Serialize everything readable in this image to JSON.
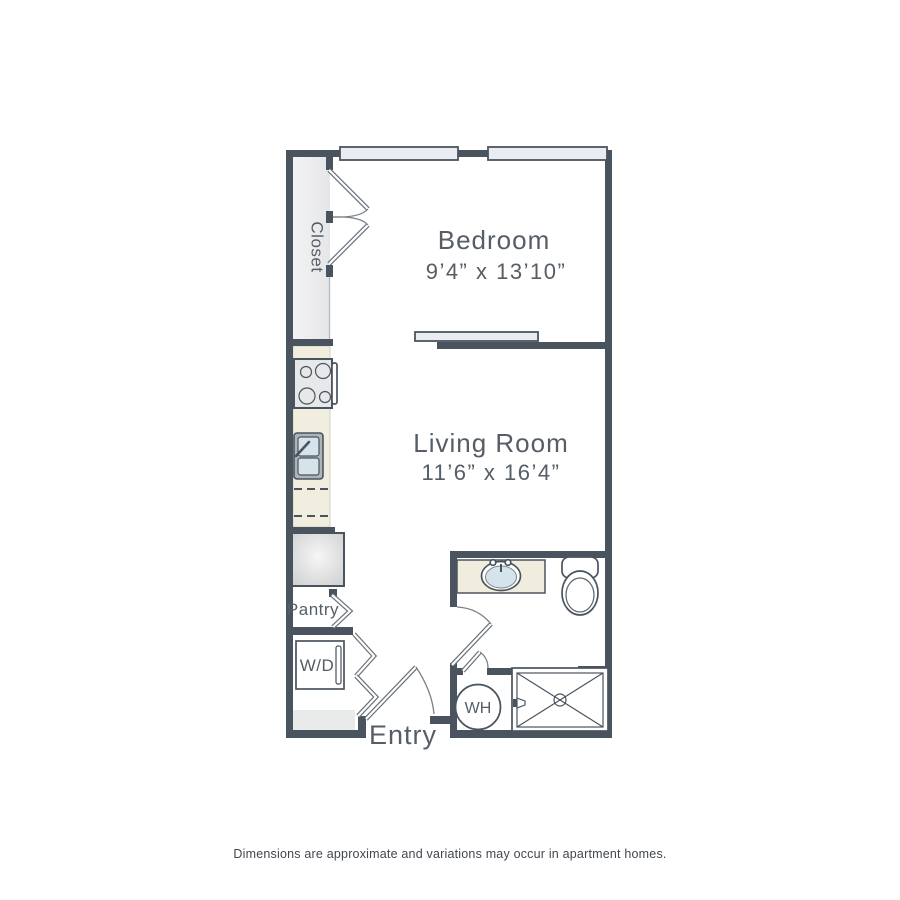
{
  "plan": {
    "rooms": {
      "closet": {
        "name": "Closet"
      },
      "bedroom": {
        "name": "Bedroom",
        "dimensions": "9’4” x 13’10”"
      },
      "living_room": {
        "name": "Living Room",
        "dimensions": "11’6” x 16’4”"
      },
      "pantry": {
        "name": "Pantry"
      },
      "washer_dryer": {
        "label": "W/D"
      },
      "entry": {
        "name": "Entry"
      },
      "water_heater": {
        "label": "WH"
      }
    },
    "fixtures": [
      "window",
      "window",
      "closet-double-doors",
      "sliding-door",
      "stove",
      "kitchen-sink",
      "dishwasher",
      "refrigerator",
      "pantry-bifold-door",
      "washer-dryer",
      "bifold-doors",
      "entry-door",
      "bathroom-door",
      "bathroom-vanity-sink",
      "toilet",
      "water-heater",
      "shower"
    ],
    "colors": {
      "wall": "#4A545E",
      "door": "#6A717A",
      "arc": "#7A8187",
      "text": "#565D65",
      "footer_text": "#41474F",
      "counter": "#F1EEE0",
      "window": "#E9EDF1",
      "sink": "#D5E3EB",
      "vanity": "#F0EDDF",
      "appliance": "#E6E8E9",
      "floor_strip": "#E9EAEA"
    }
  },
  "footer": {
    "disclaimer": "Dimensions are approximate and variations may occur in apartment homes."
  }
}
